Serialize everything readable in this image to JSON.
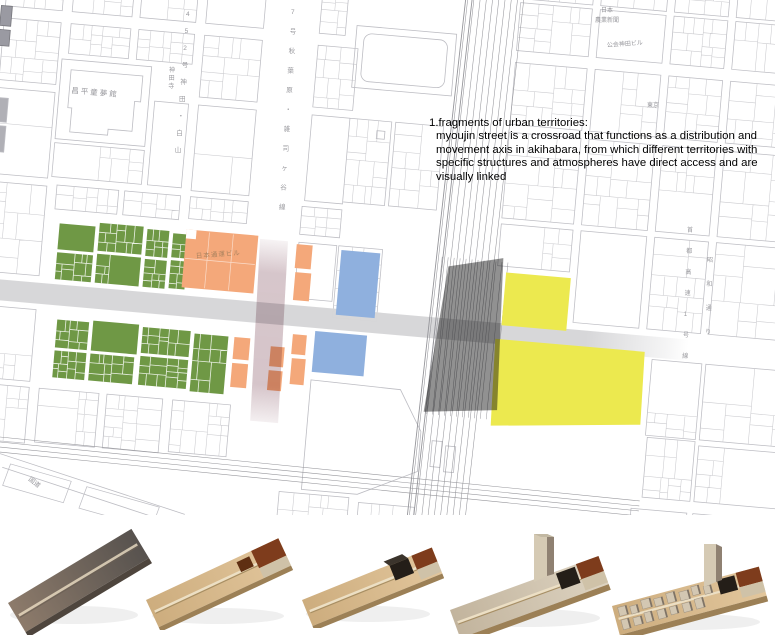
{
  "annotation": {
    "title": "1.fragments of urban territories:",
    "body_lines": [
      "myoujin street is a crossroad that functions as a distribution and",
      "movement axis in akihabara, from which different territories with",
      "specific structures and atmospheres have direct access and are",
      "visually linked"
    ]
  },
  "map": {
    "building_labels": [
      {
        "id": "shohei-domukan",
        "text": "昌平童夢館",
        "x": 58,
        "y": 121,
        "size": 7.5,
        "mode": "grid",
        "spacing": 2
      },
      {
        "id": "kanda-dera",
        "text": "神田寺",
        "x": 169,
        "y": 72,
        "size": 6,
        "mode": "vertical",
        "step": 8,
        "drift": -0.4
      },
      {
        "id": "nippon-express-building",
        "text": "日本通運ビル",
        "x": 196,
        "y": 258,
        "size": 6.5,
        "mode": "h",
        "rotate": -4,
        "color": "#a9825e",
        "spacing": 1
      },
      {
        "id": "nihon-nogyo-shimbun-line1",
        "text": "日本",
        "x": 601,
        "y": 12,
        "size": 6,
        "mode": "h"
      },
      {
        "id": "nihon-nogyo-shimbun-line2",
        "text": "農業新聞",
        "x": 595,
        "y": 22,
        "size": 6,
        "mode": "h"
      },
      {
        "id": "kokai-kanda-building",
        "text": "公会神田ビル",
        "x": 607,
        "y": 47,
        "size": 6,
        "mode": "h",
        "rotate": -4
      },
      {
        "id": "tokyo",
        "text": "東京",
        "x": 647,
        "y": 107,
        "size": 6,
        "mode": "h"
      },
      {
        "id": "kokudo",
        "text": "国道",
        "x": 28,
        "y": 480,
        "size": 6.5,
        "mode": "h",
        "rotate": 38
      },
      {
        "id": "route-452-kanda-hakusan",
        "text": "452号神田・白山",
        "x": 186,
        "y": 16,
        "size": 6.5,
        "mode": "vertical",
        "step": 17,
        "drift": -1.4
      },
      {
        "id": "route-7-akihabara-zoshigaya",
        "text": "7号秋葉原・雑司ヶ谷線",
        "x": 291,
        "y": 14,
        "size": 6.5,
        "mode": "vertical",
        "step": 19.5,
        "drift": -1.2
      },
      {
        "id": "shuto-expressway-line",
        "text": "首都高速1号線",
        "x": 687,
        "y": 232,
        "size": 6,
        "mode": "vertical",
        "step": 21,
        "drift": -0.8
      },
      {
        "id": "showa-dori",
        "text": "昭和通り",
        "x": 707,
        "y": 262,
        "size": 6,
        "mode": "vertical",
        "step": 24,
        "drift": -0.6
      }
    ]
  },
  "territories": {
    "green": "#6f9845",
    "orange": "#f4a87a",
    "blue": "#8fb0de",
    "yellow": "#ece94f",
    "station_dark": "#474747",
    "myoujin_band": "#c7b0b7",
    "main_street_band": "#d6d6d8"
  },
  "map_style": {
    "line": "#bdbdc3",
    "line_light": "#cacace",
    "rail": "#96969b",
    "label": "#98989d"
  },
  "model_colors": {
    "plank_gray_1": "#8d7b6b",
    "plank_gray_2": "#57524e",
    "plank_tan_1": "#cdad7e",
    "plank_tan_2": "#e2c69c",
    "plank_graytan_1": "#c2b49d",
    "plank_graytan_2": "#ddd3c1",
    "edge_tan": "#9c8056",
    "edge_gray": "#4e453d",
    "groove": "#ecdfc4",
    "groove_shadow": "#a78e63",
    "block_black": "#241e18",
    "block_black_top": "#3b342c",
    "block_brown": "#7e3c1c",
    "block_darkbrown": "#5f2f12",
    "block_beige": "#cfc2a8",
    "wall_light": "#d5cab4",
    "wall_dark": "#8f8172",
    "fabric": "#d3c7b2",
    "fabric_shadow": "#6b5f52",
    "photo_shadow": "#e4e4e4"
  },
  "models": {
    "items": [
      "study model 1: bare site plank",
      "study model 2: plank with territory block at end",
      "study model 3: plank with station blocks",
      "study model 4: plank with wall and station blocks",
      "study model 5: plank with urban fabric blocks"
    ]
  }
}
